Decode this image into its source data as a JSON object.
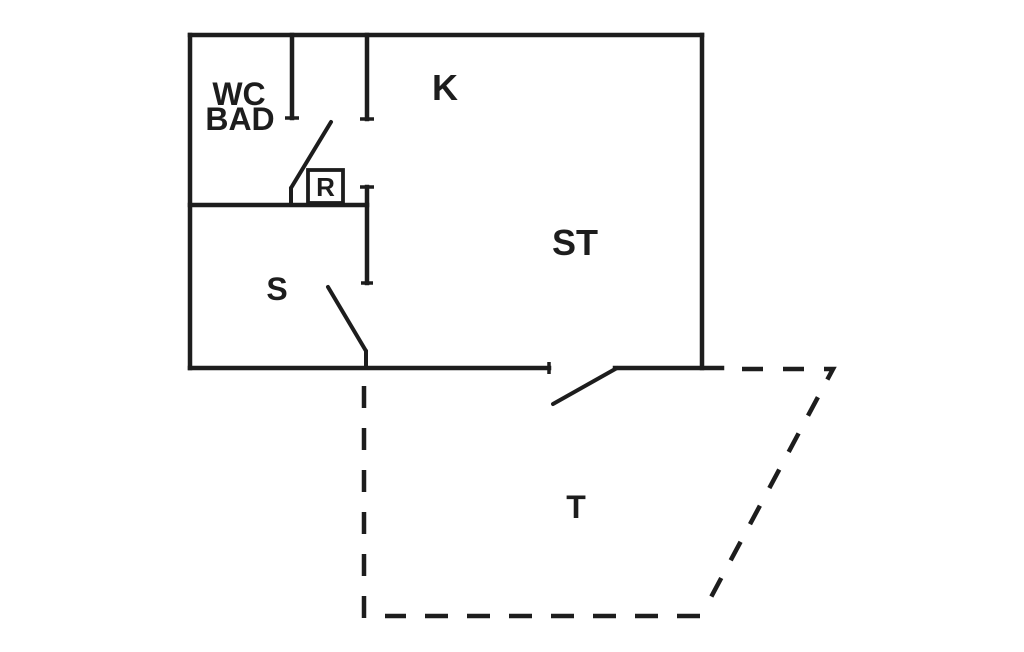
{
  "canvas": {
    "width": 1024,
    "height": 652,
    "background": "#ffffff",
    "line_color": "#1d1d1d"
  },
  "plan": {
    "walls": [
      {
        "name": "outer-wall-top",
        "x1": 190,
        "y1": 35,
        "x2": 702,
        "y2": 35
      },
      {
        "name": "outer-wall-left",
        "x1": 190,
        "y1": 35,
        "x2": 190,
        "y2": 368
      },
      {
        "name": "outer-wall-right",
        "x1": 702,
        "y1": 35,
        "x2": 702,
        "y2": 368
      },
      {
        "name": "outer-wall-bottom-west",
        "x1": 190,
        "y1": 368,
        "x2": 549,
        "y2": 368
      },
      {
        "name": "outer-wall-bottom-east",
        "x1": 615,
        "y1": 368,
        "x2": 722,
        "y2": 368
      },
      {
        "name": "wc-partition-wall",
        "x1": 292,
        "y1": 35,
        "x2": 292,
        "y2": 118
      },
      {
        "name": "kitchen-partition-upper",
        "x1": 367,
        "y1": 35,
        "x2": 367,
        "y2": 119
      },
      {
        "name": "kitchen-partition-lower",
        "x1": 367,
        "y1": 187,
        "x2": 367,
        "y2": 283
      },
      {
        "name": "s-room-north-wall",
        "x1": 190,
        "y1": 205,
        "x2": 367,
        "y2": 205
      }
    ],
    "door_lines": [
      {
        "name": "wc-door-swing",
        "x1": 331,
        "y1": 122,
        "x2": 291,
        "y2": 188
      },
      {
        "name": "wc-door-jamb",
        "x1": 291,
        "y1": 188,
        "x2": 291,
        "y2": 205
      },
      {
        "name": "s-door-swing",
        "x1": 328,
        "y1": 287,
        "x2": 366,
        "y2": 351
      },
      {
        "name": "s-door-jamb",
        "x1": 366,
        "y1": 351,
        "x2": 366,
        "y2": 368
      },
      {
        "name": "entry-door-swing",
        "x1": 553,
        "y1": 404,
        "x2": 617,
        "y2": 368
      }
    ],
    "wall_end_ticks": [
      {
        "name": "tick-wc-partition-end",
        "x1": 285,
        "y1": 118,
        "x2": 299,
        "y2": 118
      },
      {
        "name": "tick-kitchen-partition-upper",
        "x1": 360,
        "y1": 119,
        "x2": 374,
        "y2": 119
      },
      {
        "name": "tick-kitchen-partition-lower-top",
        "x1": 360,
        "y1": 187,
        "x2": 374,
        "y2": 187
      },
      {
        "name": "tick-kitchen-partition-lower-end",
        "x1": 361,
        "y1": 283,
        "x2": 373,
        "y2": 283
      },
      {
        "name": "tick-bottom-wall-west-end",
        "x1": 549,
        "y1": 362,
        "x2": 549,
        "y2": 374
      }
    ],
    "terrace_dashed_paths": [
      {
        "name": "terrace-outline-east",
        "d": "M 742 369 L 833 369 L 702 614",
        "dash": "21 20"
      },
      {
        "name": "terrace-outline-south",
        "d": "M 700 616 L 385 616",
        "dash": "23 19"
      },
      {
        "name": "terrace-outline-west",
        "d": "M 364 386 L 364 620",
        "dash": "22 20"
      }
    ],
    "labels": [
      {
        "name": "room-label-wc",
        "text": "WC",
        "x": 239,
        "y": 105,
        "size": 32
      },
      {
        "name": "room-label-bad",
        "text": "BAD",
        "x": 240,
        "y": 130,
        "size": 32
      },
      {
        "name": "room-label-k",
        "text": "K",
        "x": 445,
        "y": 100,
        "size": 36
      },
      {
        "name": "room-label-st",
        "text": "ST",
        "x": 575,
        "y": 255,
        "size": 36
      },
      {
        "name": "room-label-s",
        "text": "S",
        "x": 277,
        "y": 300,
        "size": 32
      },
      {
        "name": "room-label-t",
        "text": "T",
        "x": 576,
        "y": 518,
        "size": 32
      }
    ],
    "marker": {
      "name": "radiator-marker",
      "text": "R",
      "box": {
        "x": 308,
        "y": 170,
        "w": 35,
        "h": 33
      },
      "size": 26,
      "text_x": 325.5,
      "text_y": 196
    }
  }
}
